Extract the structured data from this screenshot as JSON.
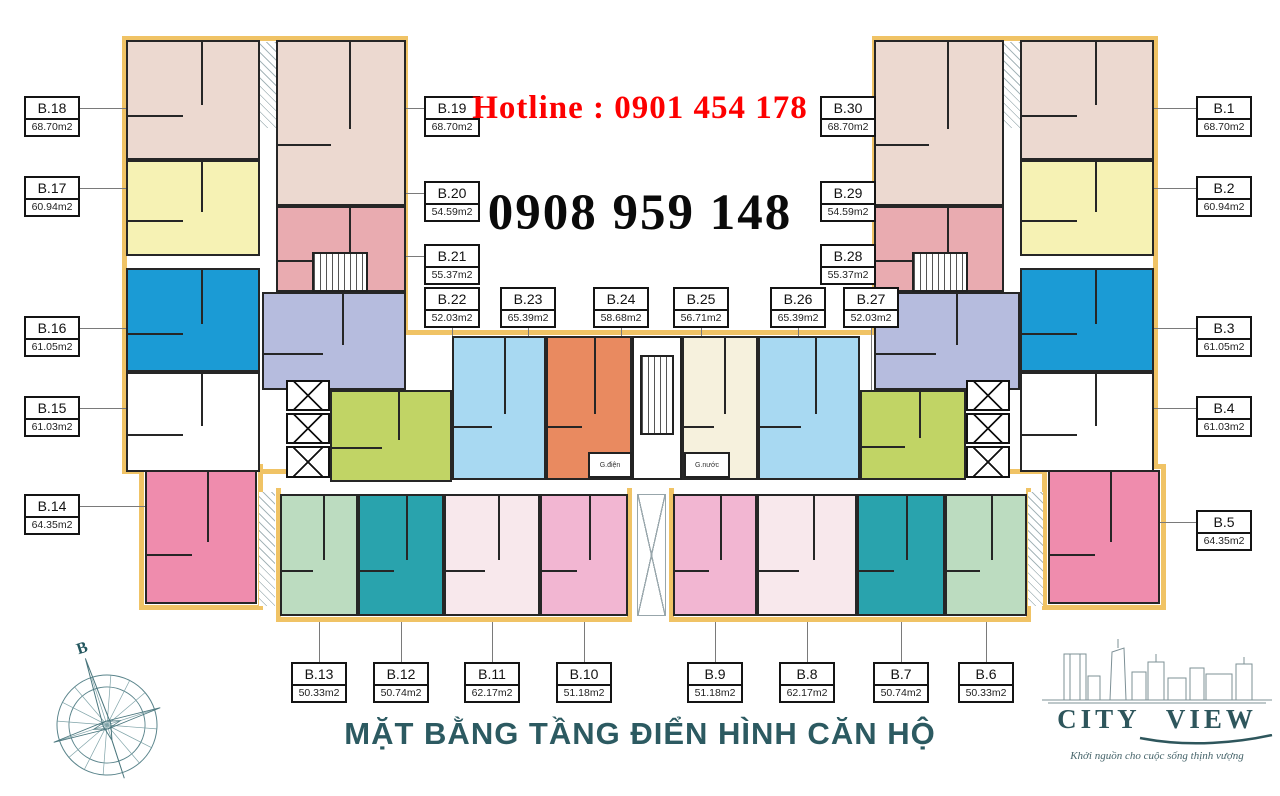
{
  "header": {
    "hotline_label": "Hotline :",
    "hotline_phone": "0901 454 178",
    "phone_large": "0908 959 148"
  },
  "title": "MẶT BẰNG TẦNG ĐIỂN HÌNH CĂN HỘ",
  "compass": {
    "north_label": "B"
  },
  "logo": {
    "brand": "CITY VIEW",
    "tagline": "Khởi nguồn cho cuộc sống thịnh vượng"
  },
  "core": {
    "electric_room": "G.điện",
    "water_room": "G.nước"
  },
  "palette": {
    "outline_yellow": "#f0c365",
    "wall_black": "#262626",
    "hotline_red": "#fd0000",
    "title_teal": "#2c5a61",
    "beige": "#ecd9d0",
    "yellow": "#f6f2b4",
    "blue": "#1b9bd5",
    "white": "#ffffff",
    "darkpink": "#ef8cad",
    "rose": "#e9abb0",
    "periwinkle": "#b6bcde",
    "lime": "#c1d465",
    "lightblue": "#a8d9f2",
    "orange": "#e98a60",
    "cream": "#f6f1dd",
    "lightgreen": "#bcdcc0",
    "teal": "#29a3ad",
    "lightpink": "#f8e8ec",
    "medpink": "#f2b6d2"
  },
  "units": [
    {
      "name": "B.1",
      "area": "68.70m2",
      "color": "beige",
      "rect": [
        1020,
        40,
        134,
        120
      ],
      "label": [
        1196,
        96
      ],
      "leader": "to-left"
    },
    {
      "name": "B.2",
      "area": "60.94m2",
      "color": "yellow",
      "rect": [
        1020,
        160,
        134,
        96
      ],
      "label": [
        1196,
        176
      ],
      "leader": "to-left"
    },
    {
      "name": "B.3",
      "area": "61.05m2",
      "color": "blue",
      "rect": [
        1020,
        268,
        134,
        104
      ],
      "label": [
        1196,
        316
      ],
      "leader": "to-left"
    },
    {
      "name": "B.4",
      "area": "61.03m2",
      "color": "white",
      "rect": [
        1020,
        372,
        134,
        100
      ],
      "label": [
        1196,
        396
      ],
      "leader": "to-left"
    },
    {
      "name": "B.5",
      "area": "64.35m2",
      "color": "darkpink",
      "rect": [
        1048,
        470,
        112,
        134
      ],
      "label": [
        1196,
        510
      ],
      "leader": "to-left"
    },
    {
      "name": "B.6",
      "area": "50.33m2",
      "color": "lightgreen",
      "rect": [
        945,
        494,
        82,
        122
      ],
      "label": [
        958,
        662
      ],
      "leader": "up"
    },
    {
      "name": "B.7",
      "area": "50.74m2",
      "color": "teal",
      "rect": [
        857,
        494,
        88,
        122
      ],
      "label": [
        873,
        662
      ],
      "leader": "up"
    },
    {
      "name": "B.8",
      "area": "62.17m2",
      "color": "lightpink",
      "rect": [
        757,
        494,
        100,
        122
      ],
      "label": [
        779,
        662
      ],
      "leader": "up"
    },
    {
      "name": "B.9",
      "area": "51.18m2",
      "color": "medpink",
      "rect": [
        673,
        494,
        84,
        122
      ],
      "label": [
        687,
        662
      ],
      "leader": "up"
    },
    {
      "name": "B.10",
      "area": "51.18m2",
      "color": "medpink",
      "rect": [
        540,
        494,
        88,
        122
      ],
      "label": [
        556,
        662
      ],
      "leader": "up"
    },
    {
      "name": "B.11",
      "area": "62.17m2",
      "color": "lightpink",
      "rect": [
        444,
        494,
        96,
        122
      ],
      "label": [
        464,
        662
      ],
      "leader": "up"
    },
    {
      "name": "B.12",
      "area": "50.74m2",
      "color": "teal",
      "rect": [
        358,
        494,
        86,
        122
      ],
      "label": [
        373,
        662
      ],
      "leader": "up"
    },
    {
      "name": "B.13",
      "area": "50.33m2",
      "color": "lightgreen",
      "rect": [
        280,
        494,
        78,
        122
      ],
      "label": [
        291,
        662
      ],
      "leader": "up"
    },
    {
      "name": "B.14",
      "area": "64.35m2",
      "color": "darkpink",
      "rect": [
        145,
        470,
        112,
        134
      ],
      "label": [
        24,
        494
      ],
      "leader": "to-right"
    },
    {
      "name": "B.15",
      "area": "61.03m2",
      "color": "white",
      "rect": [
        126,
        372,
        134,
        100
      ],
      "label": [
        24,
        396
      ],
      "leader": "to-right"
    },
    {
      "name": "B.16",
      "area": "61.05m2",
      "color": "blue",
      "rect": [
        126,
        268,
        134,
        104
      ],
      "label": [
        24,
        316
      ],
      "leader": "to-right"
    },
    {
      "name": "B.17",
      "area": "60.94m2",
      "color": "yellow",
      "rect": [
        126,
        160,
        134,
        96
      ],
      "label": [
        24,
        176
      ],
      "leader": "to-right"
    },
    {
      "name": "B.18",
      "area": "68.70m2",
      "color": "beige",
      "rect": [
        126,
        40,
        134,
        120
      ],
      "label": [
        24,
        96
      ],
      "leader": "to-right"
    },
    {
      "name": "B.19",
      "area": "68.70m2",
      "color": "beige",
      "rect": [
        276,
        40,
        130,
        166
      ],
      "label": [
        424,
        96
      ],
      "leader": "to-left"
    },
    {
      "name": "B.20",
      "area": "54.59m2",
      "color": "rose",
      "rect": [
        276,
        206,
        130,
        86
      ],
      "label": [
        424,
        181
      ],
      "leader": "to-left"
    },
    {
      "name": "B.21",
      "area": "55.37m2",
      "color": "periwinkle",
      "rect": [
        262,
        292,
        144,
        98
      ],
      "label": [
        424,
        244
      ],
      "leader": "to-left"
    },
    {
      "name": "B.22",
      "area": "52.03m2",
      "color": "lime",
      "rect": [
        330,
        390,
        122,
        92
      ],
      "label": [
        424,
        287
      ],
      "leader": "down"
    },
    {
      "name": "B.23",
      "area": "65.39m2",
      "color": "lightblue",
      "rect": [
        452,
        336,
        94,
        144
      ],
      "label": [
        500,
        287
      ],
      "leader": "down"
    },
    {
      "name": "B.24",
      "area": "58.68m2",
      "color": "orange",
      "rect": [
        546,
        336,
        86,
        144
      ],
      "label": [
        593,
        287
      ],
      "leader": "down"
    },
    {
      "name": "B.25",
      "area": "56.71m2",
      "color": "cream",
      "rect": [
        682,
        336,
        76,
        144
      ],
      "label": [
        673,
        287
      ],
      "leader": "down"
    },
    {
      "name": "B.26",
      "area": "65.39m2",
      "color": "lightblue",
      "rect": [
        758,
        336,
        102,
        144
      ],
      "label": [
        770,
        287
      ],
      "leader": "down"
    },
    {
      "name": "B.27",
      "area": "52.03m2",
      "color": "lime",
      "rect": [
        860,
        390,
        106,
        90
      ],
      "label": [
        843,
        287
      ],
      "leader": "down"
    },
    {
      "name": "B.28",
      "area": "55.37m2",
      "color": "periwinkle",
      "rect": [
        874,
        292,
        146,
        98
      ],
      "label": [
        820,
        244
      ],
      "leader": "to-right"
    },
    {
      "name": "B.29",
      "area": "54.59m2",
      "color": "rose",
      "rect": [
        874,
        206,
        130,
        86
      ],
      "label": [
        820,
        181
      ],
      "leader": "to-right"
    },
    {
      "name": "B.30",
      "area": "68.70m2",
      "color": "beige",
      "rect": [
        874,
        40,
        130,
        166
      ],
      "label": [
        820,
        96
      ],
      "leader": "to-right"
    }
  ]
}
